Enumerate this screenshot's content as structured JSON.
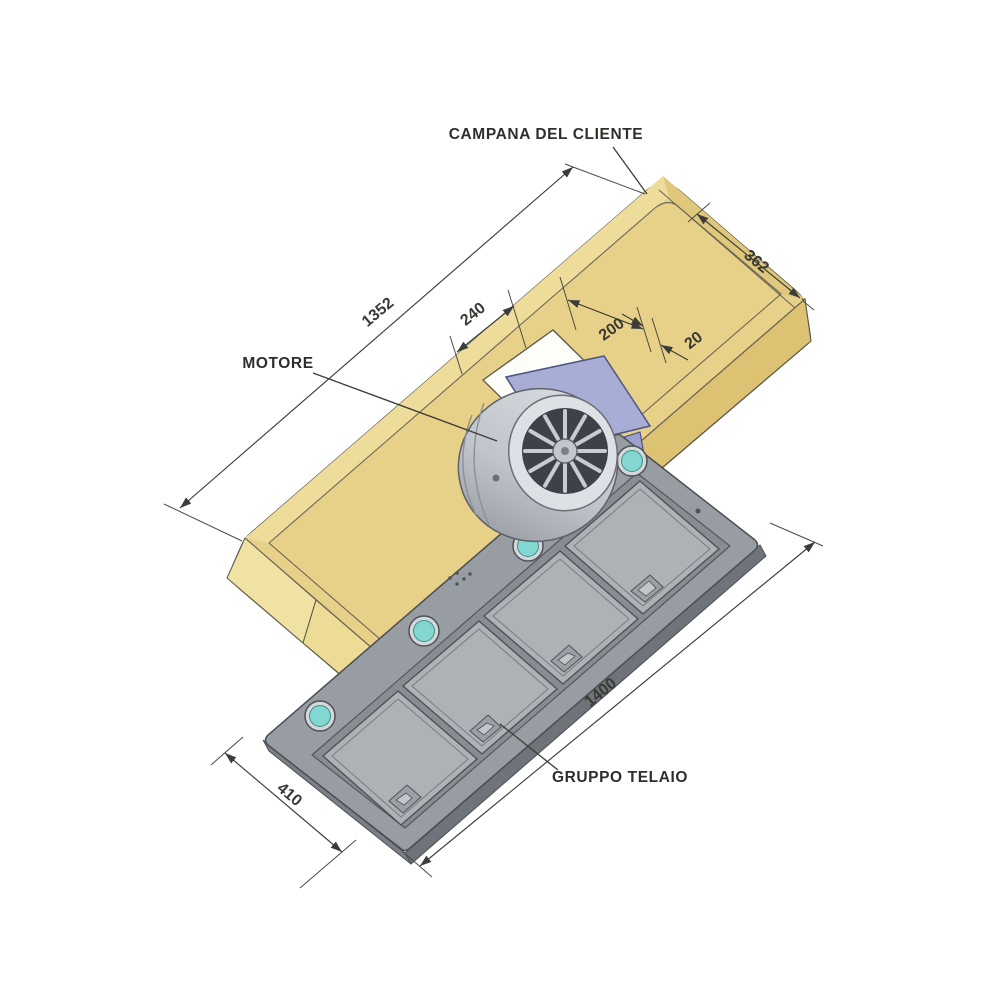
{
  "labels": {
    "hood": "CAMPANA DEL CLIENTE",
    "motor": "MOTORE",
    "frame": "GRUPPO TELAIO"
  },
  "dimensions": {
    "hood_length": "1352",
    "hood_depth": "362",
    "cutout_left_offset": "240",
    "cutout_width": "200",
    "cutout_right_margin": "20",
    "frame_length": "1400",
    "frame_width": "410"
  },
  "colors": {
    "background": "#ffffff",
    "hood_top": "#e7d088",
    "hood_band_light": "#eedc9b",
    "hood_band_dark": "#dfc77c",
    "hood_skirt_front": "#dcc272",
    "hood_skirt_end": "#f0e2a2",
    "hood_skirt_facet": "#ecdc96",
    "cutout_white": "#fdfdfa",
    "frame_body": "#989da3",
    "frame_thickness": "#6f747a",
    "frame_recess": "#878d93",
    "frame_panel": "#adb2b7",
    "latch": "#9ba0a6",
    "motor_plate": "#a8add5",
    "motor_drum_light": "#d9dce0",
    "motor_drum_dark": "#969ba3",
    "motor_face": "#dde0e4",
    "fan_dark": "#3d424a",
    "light_ring": "#d5d8db",
    "light_teal": "#82d7d0",
    "line": "#3c3c38"
  }
}
